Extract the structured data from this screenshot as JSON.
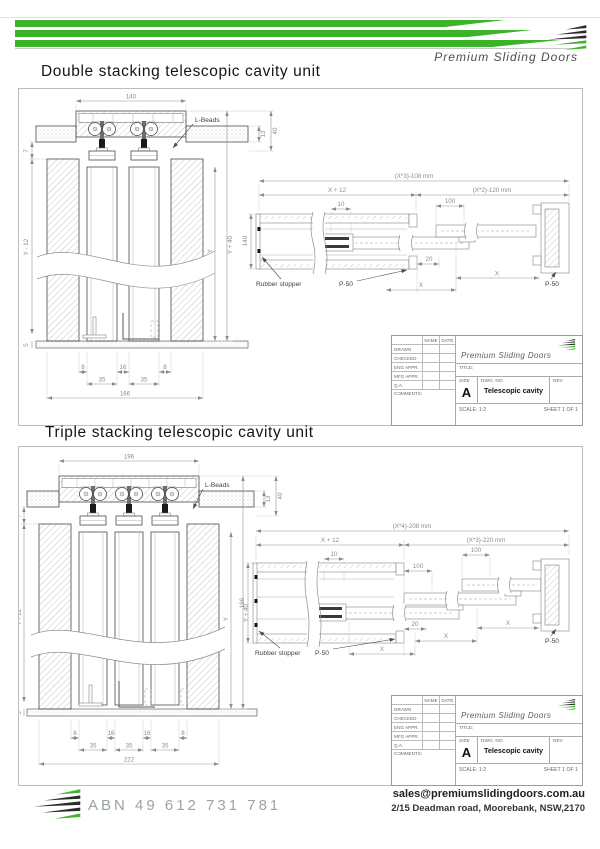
{
  "brand": {
    "name": "Premium Sliding Doors"
  },
  "titles": {
    "double": "Double stacking telescopic cavity unit",
    "triple": "Triple stacking telescopic cavity unit"
  },
  "colors": {
    "brand_green": "#3db32a",
    "ink": "#4a4a4a"
  },
  "titleblock": {
    "name_header": "NAME",
    "date_header": "DATE",
    "rows": [
      "DRAWN",
      "CHECKED",
      "ENG APPR.",
      "MFG APPR.",
      "Q.A.",
      "COMMENTS:"
    ],
    "brand": "Premium Sliding Doors",
    "title_label": "TITLE:",
    "size_label": "SIZE",
    "size_value": "A",
    "dwg_label": "DWG.  NO.",
    "dwg_value": "Telescopic cavity",
    "rev_label": "REV",
    "scale": "SCALE: 1:2",
    "sheet": "SHEET 1 OF 1"
  },
  "double": {
    "elevation": {
      "top_width": "140",
      "l_beads": "L-Beads",
      "t13": "13",
      "t40": "40",
      "t7": "7",
      "y12": "Y - 12",
      "y": "Y",
      "y40": "Y + 40",
      "t5": "5",
      "g8l": "8",
      "g16": "16",
      "g8r": "8",
      "p35l": "35",
      "p35r": "35",
      "total": "166"
    },
    "plan": {
      "overall": "(X*3)-108 mm",
      "x12": "X + 12",
      "opening": "(X*2)-120 mm",
      "t10": "10",
      "t100": "100",
      "height": "140",
      "t20": "20",
      "x1": "X",
      "x2": "X",
      "rubber": "Rubber stopper",
      "p50a": "P-50",
      "p50b": "P-50"
    }
  },
  "triple": {
    "elevation": {
      "top_width": "196",
      "l_beads": "L-Beads",
      "t13": "13",
      "t40": "40",
      "t7": "7",
      "y12": "Y - 12",
      "y": "Y",
      "y40": "Y + 40",
      "t5": "5",
      "g8l": "8",
      "g16a": "16",
      "g16b": "16",
      "g8r": "8",
      "p35a": "35",
      "p35b": "35",
      "p35c": "35",
      "total": "222"
    },
    "plan": {
      "overall": "(X*4)-208 mm",
      "x12": "X + 12",
      "opening": "(X*3)-220 mm",
      "t10": "10",
      "t100a": "100",
      "t100b": "100",
      "height": "196",
      "t20": "20",
      "x1": "X",
      "x2": "X",
      "x3": "X",
      "rubber": "Rubber stopper",
      "p50a": "P-50",
      "p50b": "P-50"
    }
  },
  "footer": {
    "abn": "ABN 49 612 731 781",
    "email": "sales@premiumslidingdoors.com.au",
    "address": "2/15 Deadman road, Moorebank, NSW,2170"
  }
}
